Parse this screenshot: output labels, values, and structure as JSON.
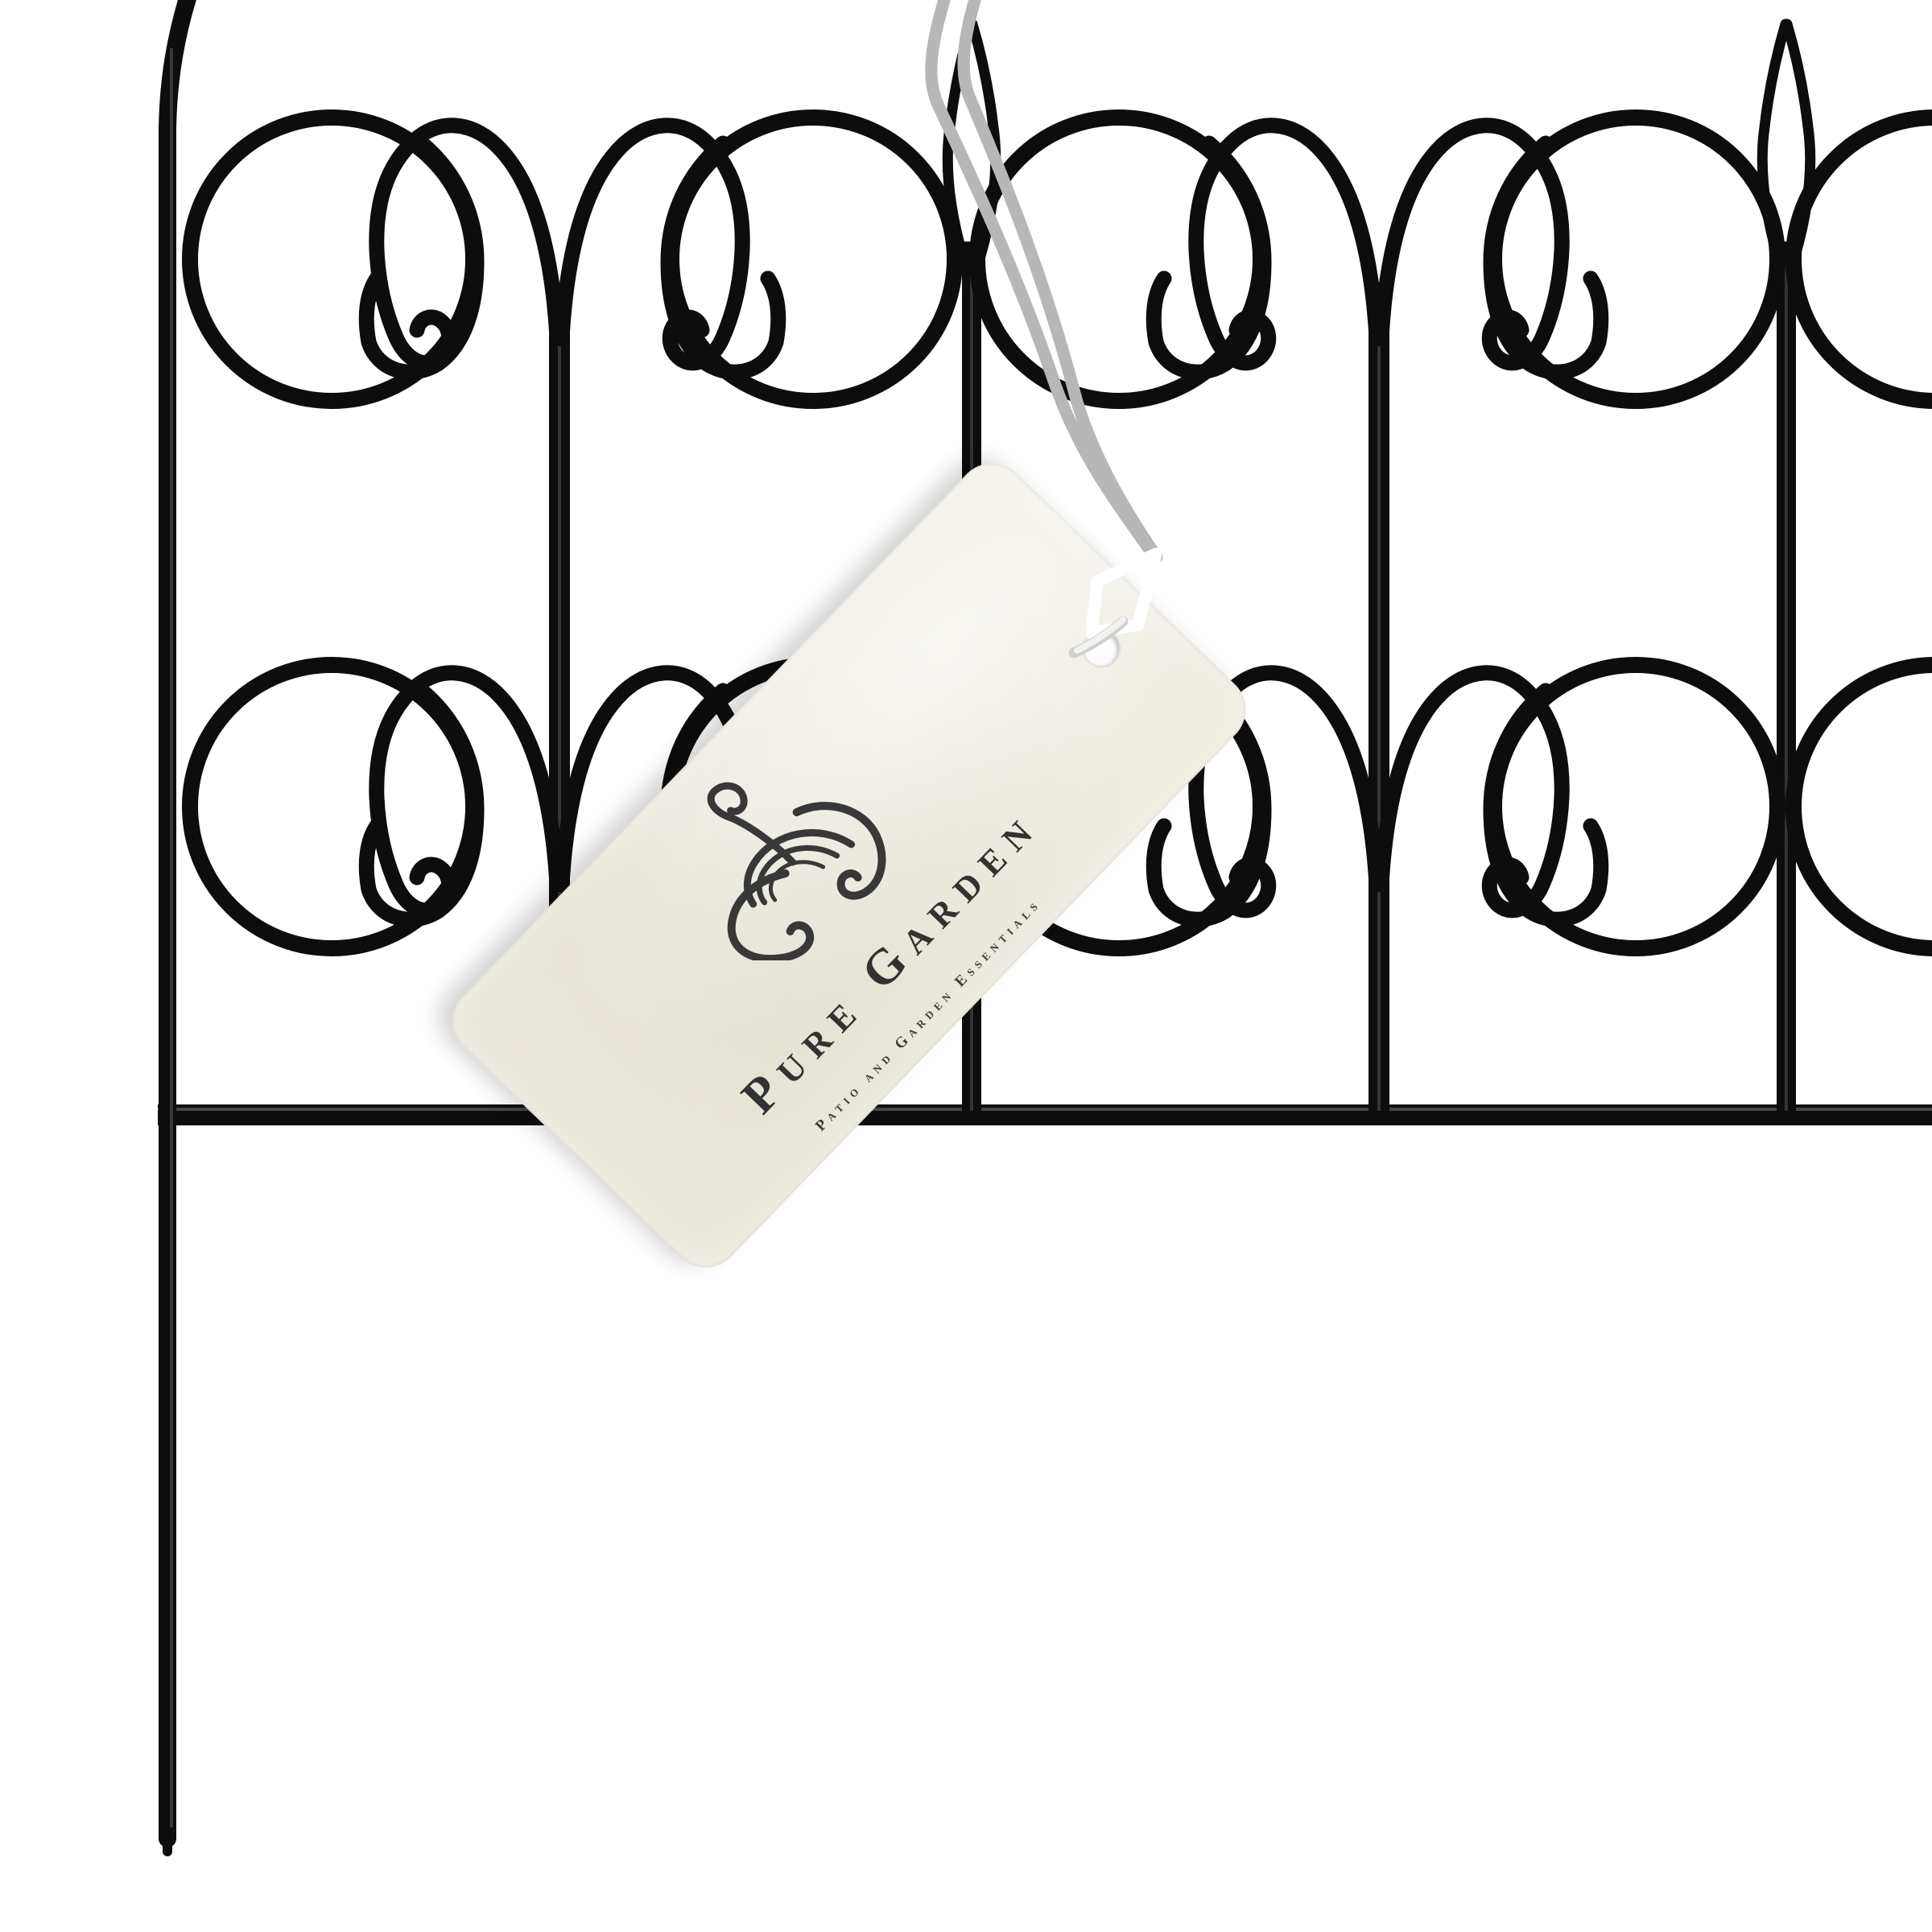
{
  "scene": {
    "type": "product-photo",
    "subject": "black wrought-iron decorative garden border fence panel with a paper hang tag",
    "background_color": "#ffffff"
  },
  "fence": {
    "metal_color": "#0d0d0d",
    "highlight_color": "#3f3f3f",
    "ornaments": [
      "c-scroll-icon",
      "rams-horn-crook-icon",
      "lancet-post-top-icon"
    ],
    "rows_of_scrollwork": 2,
    "posts_visible": 3
  },
  "tag": {
    "brand": "Pure Garden",
    "tagline": "Patio and Garden Essentials",
    "paper_color": "#efece2",
    "text_color": "#323232",
    "logo_icon": "swirl-topiary-flourish-icon",
    "hole": "round punched hole"
  },
  "string": {
    "cord_color": "#f2f2f2",
    "cord_shade_color": "#b7b7b7",
    "eyelet_stripe_color": "#d08d8c",
    "style": "twisted white cord looped over fence post into striped knot through tag hole"
  }
}
